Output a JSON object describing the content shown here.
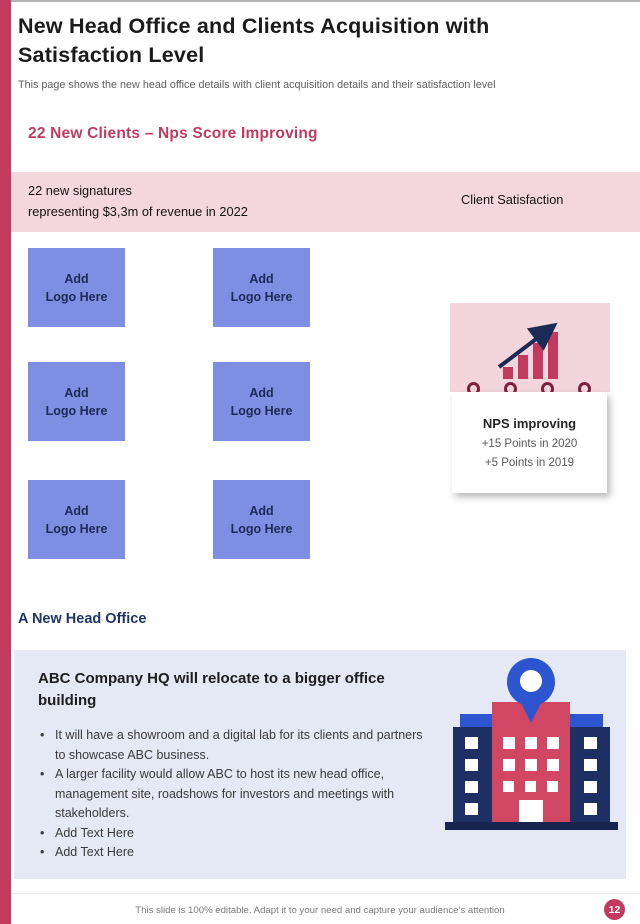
{
  "colors": {
    "accent_crimson": "#c23b5f",
    "pink_band": "#f4d6dd",
    "pink_icon_box": "#f3d5dc",
    "periwinkle": "#7e8ee2",
    "navy_text": "#1c2b56",
    "lavender_panel": "#e5e8f5",
    "royal_blue": "#2e55d0",
    "navy_tower": "#1d2f63",
    "dark_base": "#16244f",
    "ring_maroon": "#7e2040",
    "icon_crimson": "#d14663"
  },
  "page": {
    "title": "New Head Office and Clients Acquisition with Satisfaction Level",
    "subtitle": "This page shows the new head office details with client acquisition details and their satisfaction level",
    "footer_note": "This slide is 100% editable. Adapt it to your need and capture your audience’s attention",
    "page_number": "12"
  },
  "clients_section": {
    "heading": "22 New Clients – Nps Score Improving",
    "banner": {
      "left_text": "22 new signatures\nrepresenting $3,3m of revenue in 2022",
      "right_text": "Client Satisfaction"
    },
    "logo_placeholders": [
      "Add\nLogo Here",
      "Add\nLogo Here",
      "Add\nLogo Here",
      "Add\nLogo Here",
      "Add\nLogo Here",
      "Add\nLogo Here"
    ],
    "nps_card": {
      "title": "NPS improving",
      "line1": "+15 Points in 2020",
      "line2": "+5 Points in 2019"
    }
  },
  "office_section": {
    "heading": "A New Head Office",
    "panel": {
      "title": "ABC Company HQ will relocate to a bigger office building",
      "bullets": [
        "It will have a showroom and a digital lab for its clients and partners to showcase ABC business.",
        "A larger facility would allow ABC to host its new head office, management site, roadshows for investors and meetings with stakeholders.",
        "Add Text Here",
        "Add Text Here"
      ]
    }
  }
}
